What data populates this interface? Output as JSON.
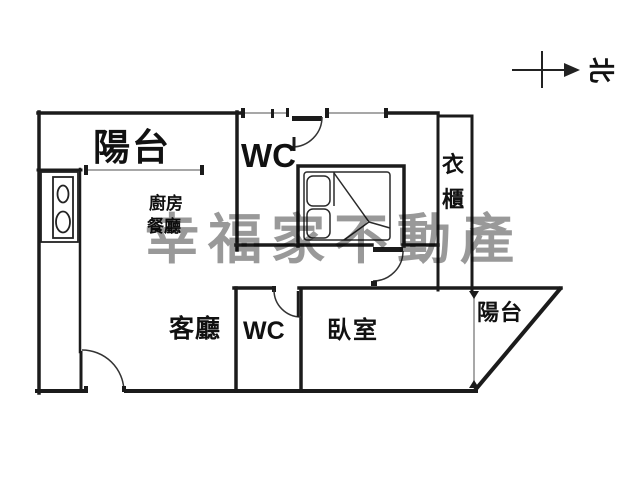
{
  "watermark": {
    "text": "幸福家不動產",
    "color": "#999999"
  },
  "compass": {
    "north_label": "北"
  },
  "rooms": {
    "balcony_top": {
      "label": "陽台"
    },
    "wc_top": {
      "label": "WC"
    },
    "wardrobe": {
      "label": "衣櫃"
    },
    "kitchen": {
      "label": "廚房"
    },
    "dining": {
      "label": "餐廳"
    },
    "living_room": {
      "label": "客廳"
    },
    "wc_bottom": {
      "label": "WC"
    },
    "bedroom": {
      "label": "臥室"
    },
    "balcony_right": {
      "label": "陽台"
    }
  },
  "colors": {
    "wall": "#1b1b1b",
    "window_line": "#8a8a8a",
    "background": "#ffffff",
    "watermark_gray": "#999999"
  }
}
